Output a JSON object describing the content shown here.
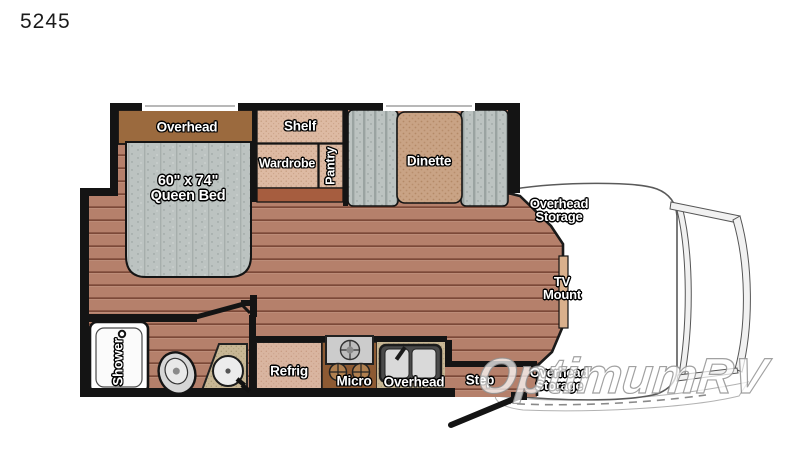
{
  "plan": {
    "model": "5245"
  },
  "watermark": {
    "text": "OptimumRV"
  },
  "labels": {
    "bed_overhead": "Overhead",
    "bed_size": "60\" x 74\"",
    "bed_name": "Queen Bed",
    "shelf": "Shelf",
    "wardrobe": "Wardrobe",
    "pantry": "Pantry",
    "dinette": "Dinette",
    "overhead_storage_top": {
      "line1": "Overhead",
      "line2": "Storage"
    },
    "tv_mount": {
      "line1": "TV",
      "line2": "Mount"
    },
    "overhead_storage_bottom": {
      "line1": "Overhead",
      "line2": "Storage"
    },
    "shower": "Shower",
    "refrigerator": "Refrig",
    "microwave": "Micro",
    "kitchen_overhead": "Overhead",
    "step": "Step"
  },
  "colors": {
    "wall": "#141414",
    "floor_base": "#b5806b",
    "floor_line": "#7c4938",
    "cabinet_brown": "#9b6a3e",
    "cabinet_dark": "#8d5a33",
    "fabric_gray": "#bcc3c1",
    "tan_light": "#ddbaa3",
    "table_tan": "#c9a385",
    "counter_speckle": "#c8b795",
    "fridge_tan": "#d9b5a0",
    "wood_trim": "#a65d3f"
  }
}
